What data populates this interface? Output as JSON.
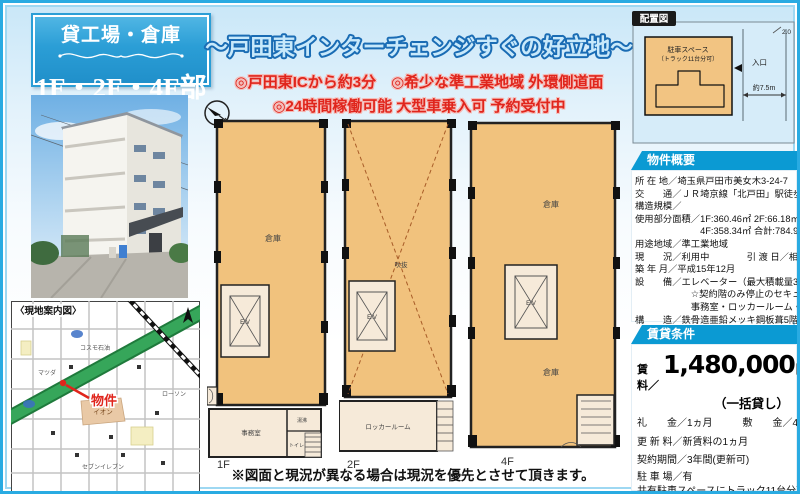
{
  "flyer": {
    "badge": {
      "line1": "貸工場・倉庫",
      "line2": "1F・2F・4F部分"
    },
    "headline": {
      "title": "〜戸田東インターチェンジすぐの好立地〜",
      "point1": "◎戸田東ICから約3分　◎希少な準工業地域 外環側道面",
      "point2": "◎24時間稼働可能 大型車乗入可 予約受付中"
    },
    "disclaimer": "※図面と現況が異なる場合は現況を優先とさせて頂きます。"
  },
  "layout_diagram": {
    "title": "配置図",
    "parking": "駐車スペース",
    "parking_note": "（トラック11台分可）",
    "entrance": "入口",
    "width_label": "約7.5m",
    "offset_label": "2.0"
  },
  "site_map": {
    "title": "〈現地案内図〉",
    "property": "物件",
    "poi": {
      "aeon": "イオン",
      "cosmo": "コスモ石油",
      "mazda": "マツダ",
      "lawson": "ローソン",
      "seven": "セブンイレブン"
    }
  },
  "floor_plans": {
    "f1": {
      "name": "1F",
      "warehouse": "倉庫",
      "elevator": "E.V",
      "office": "事務室",
      "kitchen": "湯沸",
      "toilet": "トイレ"
    },
    "f2": {
      "name": "2F",
      "void_label": "吹抜",
      "elevator": "E.V",
      "locker": "ロッカールーム"
    },
    "f4": {
      "name": "4F",
      "warehouse_upper": "倉庫",
      "warehouse_lower": "倉庫",
      "elevator": "E.V"
    }
  },
  "overview": {
    "title": "物件概要",
    "lines": [
      "所 在 地／埼玉県戸田市美女木3-24-7",
      "交　　通／ＪＲ埼京線「北戸田」駅徒歩18分",
      "構造規模／",
      "使用部分面積／1F:360.46㎡ 2F:66.18㎡",
      "　　　　　　　4F:358.34㎡ 合計:784.98㎡",
      "用途地域／準工業地域",
      "現　　況／利用中　　　　引 渡 日／相談",
      "築 年 月／平成15年12月",
      "設　　備／エレベーター（最大積載量3ｔ）",
      "　　　　　　☆契約階のみ停止のセキュリティカード付",
      "　　　　　　事務室・ロッカールーム・トイレ・電気・水道",
      "構　　造／鉄骨造亜鉛メッキ鋼板葺5階建"
    ]
  },
  "terms": {
    "title": "賃貸条件",
    "rent_label": "賃　料／",
    "rent_value": "1,480,000",
    "rent_unit": "円",
    "rent_note": "（一括貸し）",
    "lines": [
      "礼　　金／1ヵ月　　　敷　　金／4ヵ月",
      "更 新 料／新賃料の1ヵ月",
      "契約期間／3年間(更新可)",
      "駐 車 場／有",
      "共有駐車スペースにトラック11台分可",
      "保証会社加入要"
    ]
  }
}
